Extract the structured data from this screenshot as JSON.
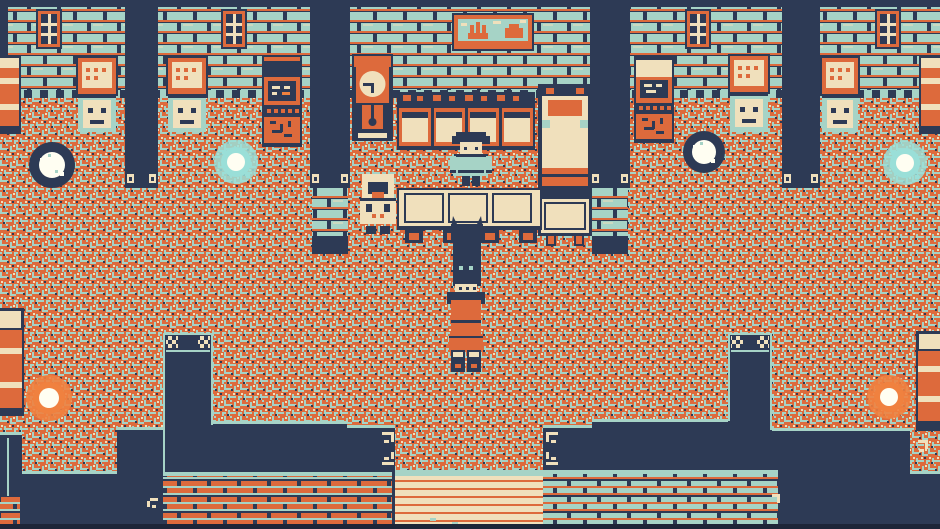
{
  "meta": {
    "scene_title": "Pixel-art tavern interior — retro 4-color RPG scene",
    "art_style": "Game Boy style, 4-color palette (navy, orange, cream, teal)",
    "viewport": "940x529"
  },
  "palette": {
    "navy": "#2d3a55",
    "navy_deep": "#1d2538",
    "orange": "#dd6a3c",
    "orange_bright": "#f0813f",
    "cream": "#f0e0bc",
    "teal": "#a6d3c6",
    "teal_bright": "#9adfd8",
    "white": "#fffef2"
  },
  "scene": {
    "room": "Inn / tavern hall with a bar counter at center, patterned carpet floor, and a staircase exit at bottom center",
    "characters": [
      {
        "id": "innkeeper",
        "appearance": "teal-shirted innkeeper with dark hair",
        "location": "standing behind the bar counter, center"
      },
      {
        "id": "patron",
        "appearance": "cream-hooded elderly patron",
        "location": "standing at the left end of the counter"
      },
      {
        "id": "player",
        "appearance": "tall dark-hooded figure with glinting teal eyes, orange robe and dark boots",
        "location": "center of the room, walking toward the stairs"
      }
    ],
    "furniture": [
      {
        "id": "painting",
        "description": "framed landscape painting with orange castle and hill on teal sky",
        "location": "top center wall"
      },
      {
        "id": "grandfather-clock",
        "description": "orange clock with cream face and pendulum slot",
        "location": "center wall, left of the bar"
      },
      {
        "id": "bar-shelves",
        "description": "row of four cabinets with bottles on a dark shelf",
        "location": "behind the counter"
      },
      {
        "id": "bar-counter",
        "description": "cream counter with three inset panels and four stools",
        "location": "center"
      },
      {
        "id": "bed",
        "description": "bed with orange pillow and footboard",
        "location": "right side of the bar"
      },
      {
        "id": "side-table",
        "description": "cream table below the bed",
        "location": "right side of the bar"
      },
      {
        "id": "dressers",
        "count": 4,
        "description": "cabinets with cream drawer panels, two knob 'eyes' and a handle",
        "locations": [
          "left wall",
          "mid-left wall",
          "mid-right wall",
          "right wall"
        ]
      },
      {
        "id": "jukebox-machines",
        "count": 2,
        "description": "tall machines with dark screens, button dots and patterned lower panel",
        "locations": [
          "mid-left wall",
          "mid-right wall"
        ]
      },
      {
        "id": "windows",
        "count": 4,
        "description": "dark windows with cream mullions and orange frames"
      },
      {
        "id": "barrels",
        "count": 4,
        "description": "orange barrels with cream hoops",
        "locations": [
          "left wall edge",
          "right wall edge",
          "bottom-left floor edge",
          "bottom-right floor edge"
        ]
      }
    ],
    "lights": [
      {
        "id": "orb-white-left",
        "color_key": "white",
        "location": "left floor"
      },
      {
        "id": "orb-teal-left",
        "color_key": "teal_bright",
        "location": "mid-left floor"
      },
      {
        "id": "orb-white-right",
        "color_key": "white",
        "location": "mid-right floor"
      },
      {
        "id": "orb-teal-right",
        "color_key": "teal_bright",
        "location": "right floor"
      },
      {
        "id": "orb-orange-left",
        "color_key": "orange_bright",
        "location": "bottom-left floor"
      },
      {
        "id": "orb-orange-right",
        "color_key": "orange_bright",
        "location": "bottom-right floor"
      }
    ],
    "architecture": [
      {
        "id": "brick-walls",
        "description": "teal bricks with orange mortar lines, checkered base trim",
        "location": "top of room"
      },
      {
        "id": "pillars",
        "count": 4,
        "description": "dark columns with cream feet"
      },
      {
        "id": "half-walls",
        "count": 2,
        "description": "brick half-walls enclosing the bar below the inner pillars"
      },
      {
        "id": "lower-level",
        "description": "dark pit with teal-edged ledges, two newel posts with checkered caps, brick retaining walls"
      },
      {
        "id": "stairs",
        "description": "cream steps with orange nosing lines leading down",
        "location": "bottom center"
      }
    ]
  }
}
